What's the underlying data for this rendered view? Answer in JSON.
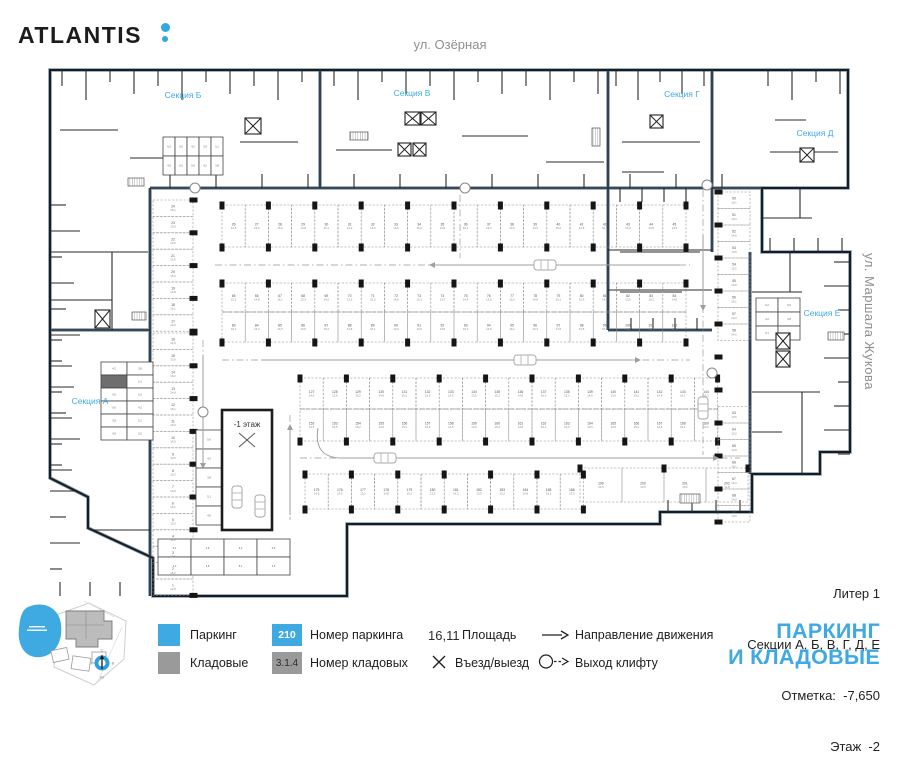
{
  "header": {
    "logo": "ATLANTIS",
    "street_top": "ул. Озёрная",
    "street_right": "ул. Маршала Жукова"
  },
  "minimap": {
    "compass": {
      "n": "С",
      "e": "В",
      "s": "Ю",
      "w": "З"
    }
  },
  "plan": {
    "sections": [
      {
        "id": "a",
        "label": "Секция А"
      },
      {
        "id": "b",
        "label": "Секция Б"
      },
      {
        "id": "v",
        "label": "Секция В"
      },
      {
        "id": "g",
        "label": "Секция Г"
      },
      {
        "id": "d",
        "label": "Секция Д"
      },
      {
        "id": "e",
        "label": "Секция Е"
      }
    ],
    "ramp_label": "-1 этаж",
    "parking_rows": [
      {
        "o": "h",
        "x": 222,
        "y": 205,
        "w": 23.2,
        "h": 42,
        "count": 20,
        "start": 26,
        "step": 1,
        "cols": "tb"
      },
      {
        "o": "h",
        "x": 222,
        "y": 283,
        "w": 23.2,
        "h": 29,
        "count": 20,
        "start": 65,
        "step": 1,
        "cols": "t"
      },
      {
        "o": "h",
        "x": 222,
        "y": 312,
        "w": 23.2,
        "h": 30,
        "count": 20,
        "start": 83,
        "step": 1,
        "cols": "b"
      },
      {
        "o": "h",
        "x": 300,
        "y": 378,
        "w": 23.2,
        "h": 31,
        "count": 18,
        "start": 127,
        "step": 1,
        "cols": "t"
      },
      {
        "o": "h",
        "x": 300,
        "y": 409,
        "w": 23.2,
        "h": 32,
        "count": 18,
        "start": 152,
        "step": 1,
        "cols": "b"
      },
      {
        "o": "h",
        "x": 305,
        "y": 474,
        "w": 23.2,
        "h": 35,
        "count": 12,
        "start": 175,
        "step": 1,
        "cols": "tb"
      },
      {
        "o": "h",
        "x": 580,
        "y": 468,
        "w": 42,
        "h": 34,
        "count": 4,
        "start": 199,
        "step": 1,
        "cols": "t"
      },
      {
        "o": "v",
        "x": 153,
        "y": 200,
        "w": 40,
        "h": 16.4,
        "count": 8,
        "start": 24,
        "step": -1
      },
      {
        "o": "v",
        "x": 153,
        "y": 333,
        "w": 40,
        "h": 16.4,
        "count": 16,
        "start": 16,
        "step": -1
      },
      {
        "o": "v",
        "x": 718,
        "y": 192,
        "w": 32,
        "h": 16.5,
        "count": 20,
        "start": 50,
        "step": 1,
        "gap": [
          340,
          392
        ]
      }
    ],
    "area_values": [
      "14,5",
      "13,5",
      "15,2",
      "14,8",
      "16,1",
      "13,3"
    ],
    "storage_values": [
      "4,2",
      "3,8",
      "5,1",
      "4,5",
      "6,2",
      "5,6"
    ]
  },
  "info": {
    "lines": [
      "Литер 1",
      "Секции А, Б, В, Г, Д, Е",
      "Отметка:  -7,650",
      "Этаж  -2"
    ],
    "title": [
      "ПАРКИНГ",
      "И КЛАДОВЫЕ"
    ]
  },
  "legend": {
    "parking": {
      "label": "Паркинг"
    },
    "storage": {
      "label": "Кладовые"
    },
    "parking_number": {
      "value": "210",
      "label": "Номер паркинга"
    },
    "storage_number": {
      "value": "3.1.4",
      "label": "Номер кладовых"
    },
    "area": {
      "value": "16,11",
      "label": "Площадь"
    },
    "entrance": {
      "label": "Въезд/выезд"
    },
    "direction": {
      "label": "Направление движения"
    },
    "lift_exit": {
      "label": "Выход клифту"
    }
  },
  "colors": {
    "accent": "#3fa9e1",
    "storage_gray": "#9a9a9a",
    "boundary": "#7e9bb3"
  }
}
